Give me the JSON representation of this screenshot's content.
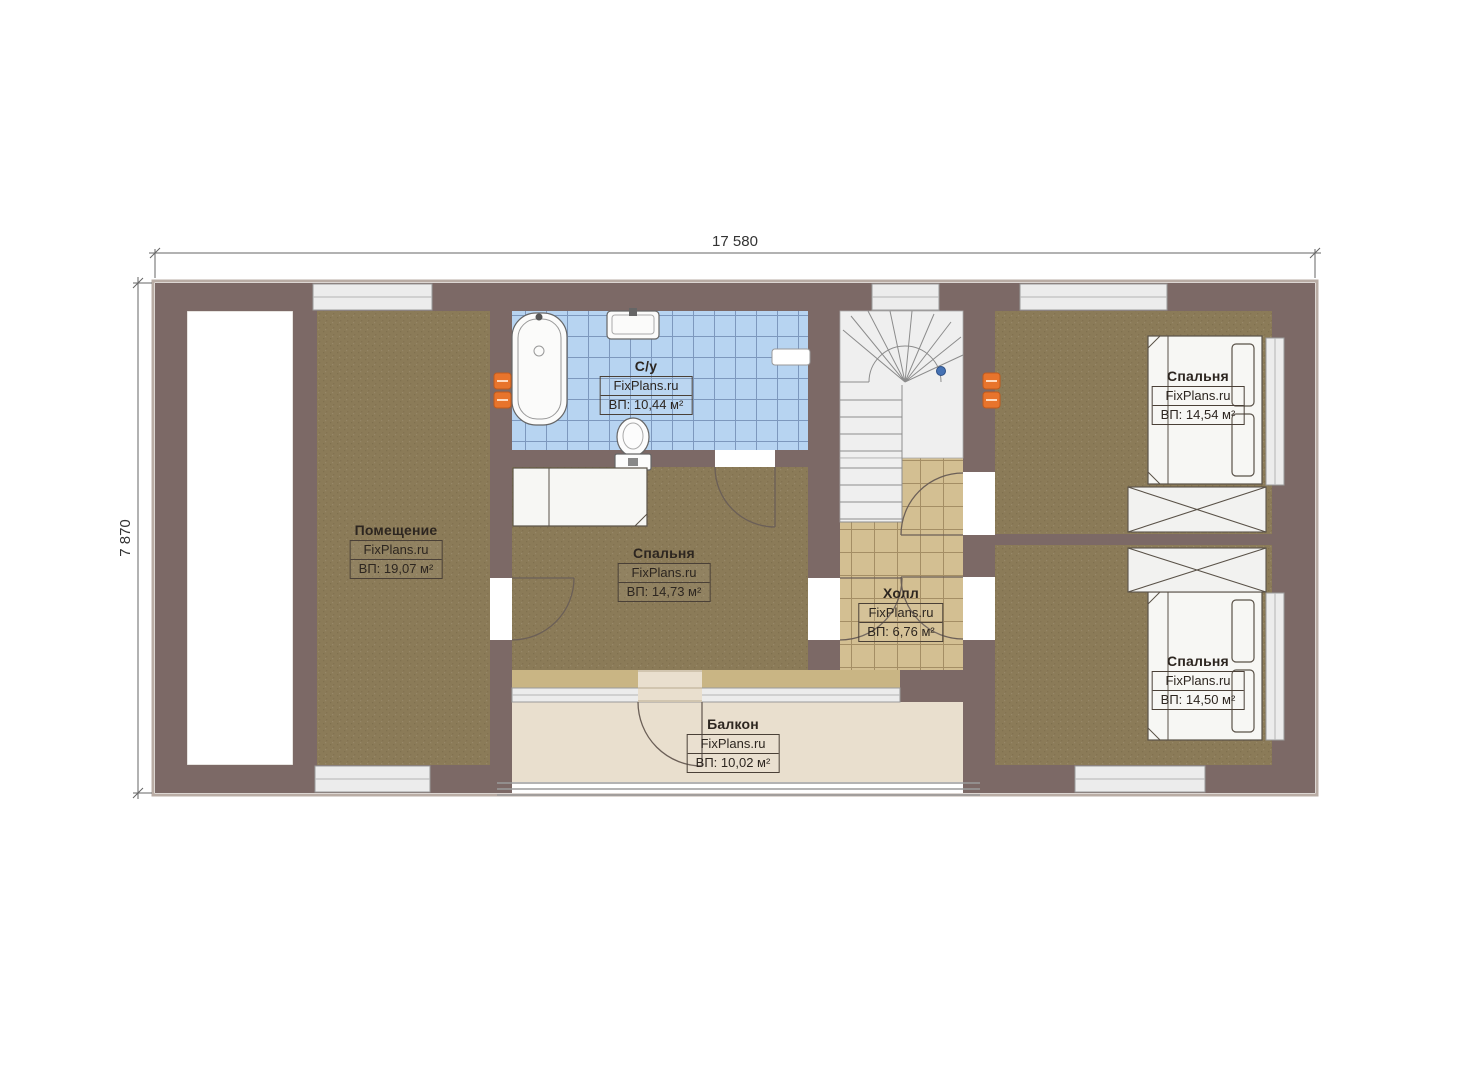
{
  "plan_title": "Floor plan",
  "dimensions": {
    "width": "17 580",
    "height": "7 870"
  },
  "rooms": [
    {
      "id": "pomeshchenie",
      "name": "Помещение",
      "brand": "FixPlans.ru",
      "area": "ВП: 19,07 м²"
    },
    {
      "id": "bathroom",
      "name": "С/у",
      "brand": "FixPlans.ru",
      "area": "ВП: 10,44 м²"
    },
    {
      "id": "bedroom-middle",
      "name": "Спальня",
      "brand": "FixPlans.ru",
      "area": "ВП: 14,73 м²"
    },
    {
      "id": "hall",
      "name": "Холл",
      "brand": "FixPlans.ru",
      "area": "ВП: 6,76 м²"
    },
    {
      "id": "bedroom-top-right",
      "name": "Спальня",
      "brand": "FixPlans.ru",
      "area": "ВП: 14,54 м²"
    },
    {
      "id": "bedroom-bottom-right",
      "name": "Спальня",
      "brand": "FixPlans.ru",
      "area": "ВП: 14,50 м²"
    },
    {
      "id": "balcony",
      "name": "Балкон",
      "brand": "FixPlans.ru",
      "area": "ВП: 10,02 м²"
    }
  ],
  "colors": {
    "wall": "#7c6966",
    "wall_outline": "#b9aca4",
    "room_floor": "#8b7b58",
    "bath_tile": "#b7d4f1",
    "bath_grid": "#7d98bd",
    "hall_tile": "#d3bf92",
    "balcony_floor": "#e9dfce",
    "sill_strip": "#c9b584",
    "window_fill": "#ececec",
    "stairs_bg": "#efefef",
    "radiator": "#e8742c",
    "fixture": "#f7f7f4"
  }
}
